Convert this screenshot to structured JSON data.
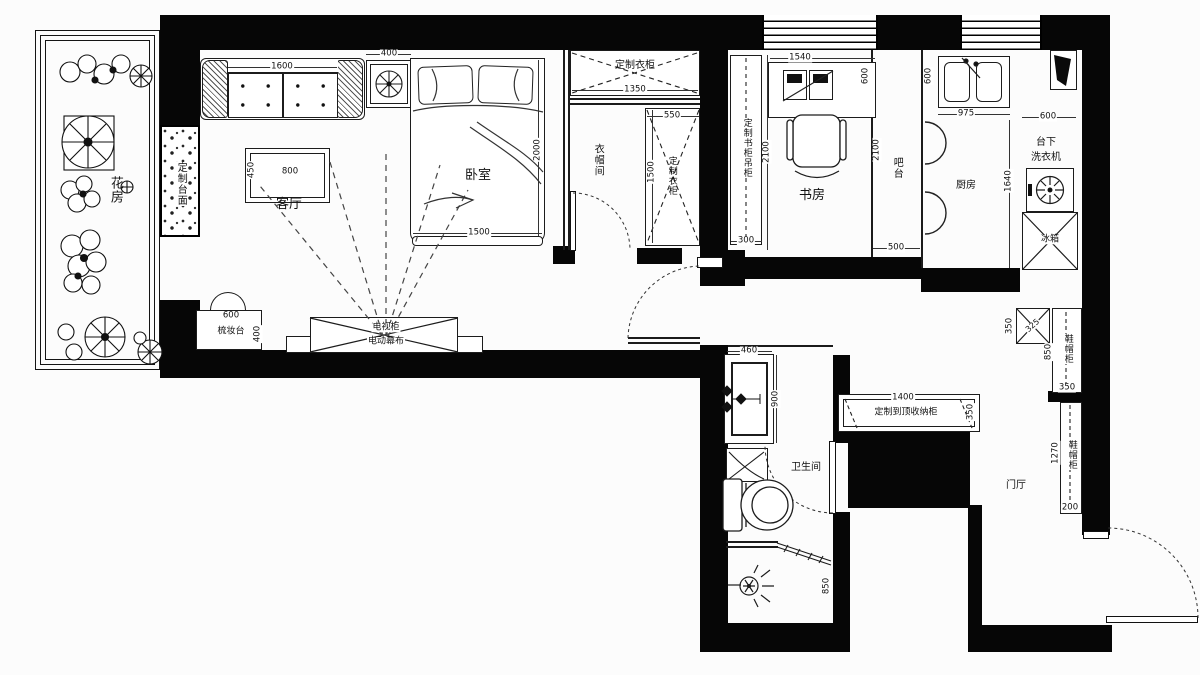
{
  "flower_room": {
    "label": "花房"
  },
  "living_room": {
    "label": "客厅",
    "counter_label": "定制台面",
    "sofa_width": "1600",
    "side_table_width": "400",
    "coffee_table_width": "800",
    "coffee_table_depth": "450",
    "dresser_label": "梳妆台",
    "dresser_width": "600",
    "dresser_depth": "400",
    "tv_cabinet_label": "电视柜",
    "screen_label": "电动幕布"
  },
  "bedroom": {
    "label": "卧室",
    "bed_width": "1500",
    "bed_length": "2000"
  },
  "cloakroom": {
    "label": "衣帽间",
    "top_wardrobe_label": "定制衣柜",
    "top_wardrobe_width": "1350",
    "side_wardrobe_label": "定制衣柜",
    "side_wardrobe_width": "550",
    "side_wardrobe_length": "1500"
  },
  "bookcase": {
    "label": "定制书柜吊柜",
    "depth": "300",
    "length": "2100"
  },
  "study": {
    "label": "书房",
    "desk_width": "1540",
    "desk_depth": "600",
    "room_length": "2100"
  },
  "bar": {
    "label": "吧台",
    "length": "2100",
    "width": "500"
  },
  "kitchen": {
    "label": "厨房",
    "sink_width": "975",
    "sink_depth": "600",
    "washer_label_1": "台下",
    "washer_label_2": "洗衣机",
    "washer_width": "600",
    "washer_length": "1640",
    "fridge_label": "冰箱"
  },
  "bathroom": {
    "label": "卫生间",
    "vanity_width": "460",
    "vanity_length": "900",
    "shower_length": "850"
  },
  "hallway": {
    "storage_label": "定制到顶收纳柜",
    "storage_width": "1400",
    "storage_depth": "350",
    "corner_cab_width": "325",
    "corner_cab_depth": "350",
    "shoe1_label": "鞋帽柜",
    "shoe1_length": "850",
    "shoe1_depth": "350",
    "shoe2_label": "鞋帽柜",
    "shoe2_length": "1270",
    "shoe2_depth": "200"
  },
  "foyer": {
    "label": "门厅"
  }
}
